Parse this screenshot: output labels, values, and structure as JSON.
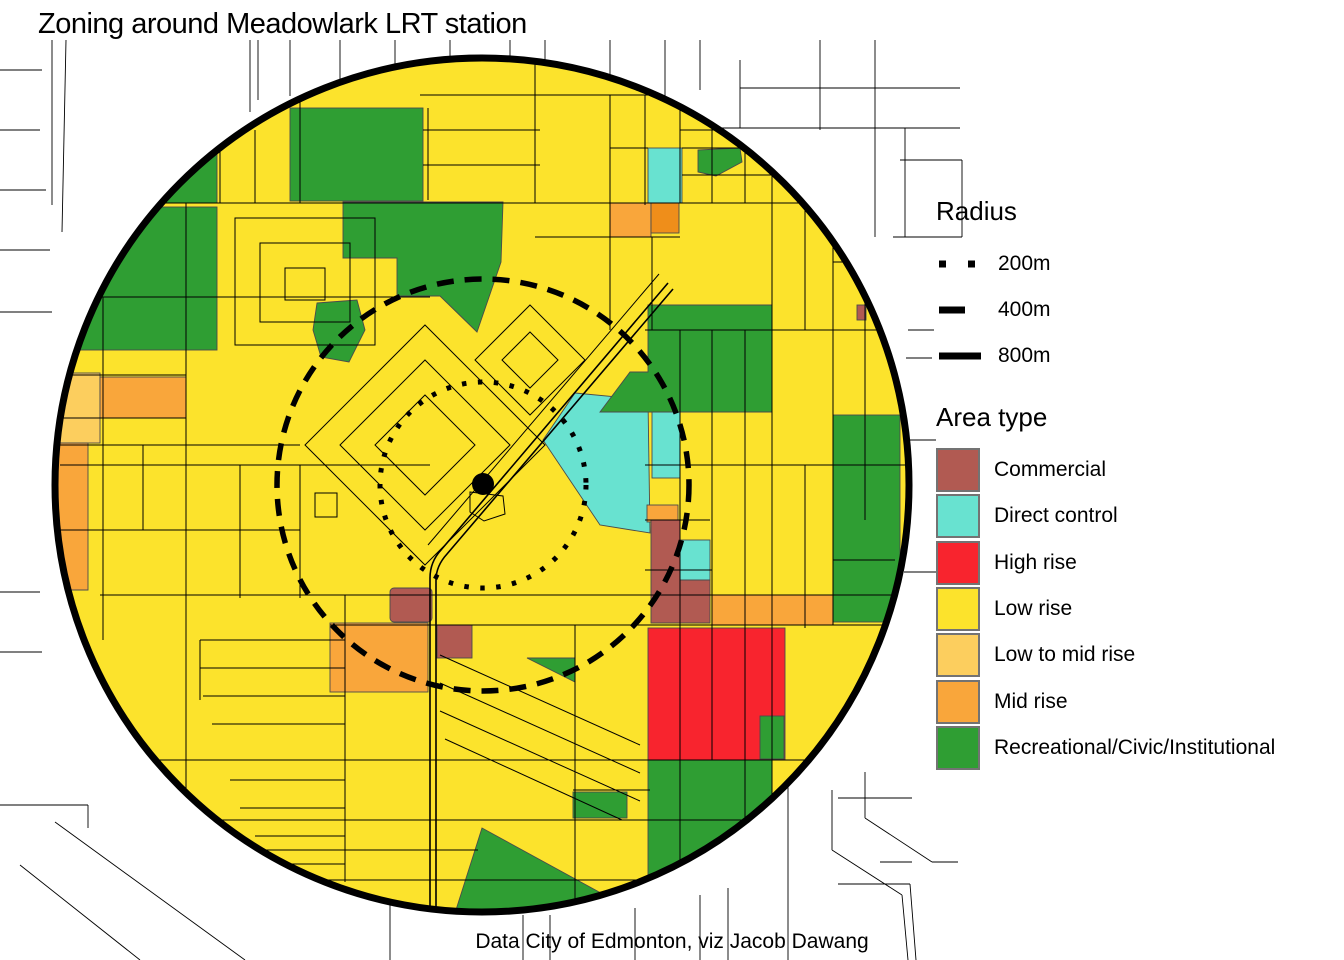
{
  "title": "Zoning around Meadowlark LRT station",
  "caption": "Data City of Edmonton, viz Jacob Dawang",
  "legend_radius": {
    "title": "Radius",
    "items": [
      {
        "label": "200m",
        "style": "dotted"
      },
      {
        "label": "400m",
        "style": "dashed"
      },
      {
        "label": "800m",
        "style": "solid"
      }
    ]
  },
  "legend_area_type": {
    "title": "Area type",
    "items": [
      {
        "key": "commercial",
        "label": "Commercial",
        "color": "#B15A52"
      },
      {
        "key": "direct-control",
        "label": "Direct control",
        "color": "#68E2D0"
      },
      {
        "key": "high-rise",
        "label": "High rise",
        "color": "#F8242E"
      },
      {
        "key": "low-rise",
        "label": "Low rise",
        "color": "#FCE32C"
      },
      {
        "key": "low-to-mid-rise",
        "label": "Low to mid rise",
        "color": "#FCCE5E"
      },
      {
        "key": "mid-rise",
        "label": "Mid rise",
        "color": "#F9A63B"
      },
      {
        "key": "recreational-civic-institutional",
        "label": "Recreational/Civic/Institutional",
        "color": "#2F9E33"
      }
    ]
  },
  "map": {
    "colors": {
      "background": "#FFFFFF",
      "street": "#000000",
      "ring": "#000000",
      "station": "#000000"
    }
  }
}
